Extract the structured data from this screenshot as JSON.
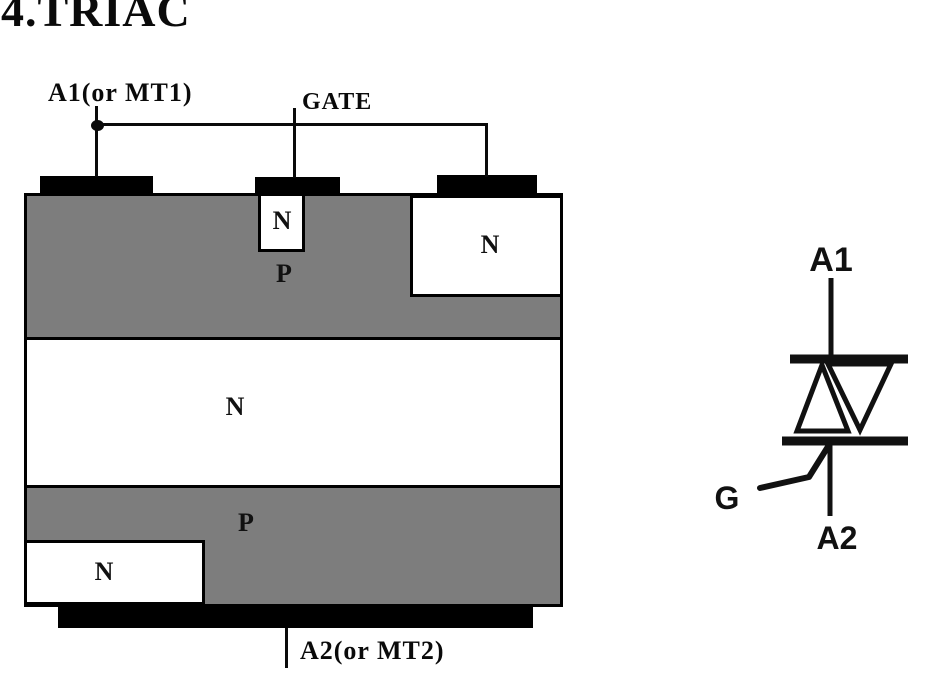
{
  "page": {
    "title": "4.TRIAC"
  },
  "structure": {
    "terminal_a1": "A1(or MT1)",
    "terminal_gate": "GATE",
    "terminal_a2": "A2(or MT2)",
    "labels": {
      "gate_n_well": "N",
      "top_p": "P",
      "right_n": "N",
      "middle_n": "N",
      "bottom_p": "P",
      "bottom_left_n": "N"
    }
  },
  "symbol": {
    "a1": "A1",
    "gate": "G",
    "a2": "A2"
  },
  "colors": {
    "p_region": "#7d7d7d",
    "n_region": "#ffffff",
    "electrode": "#000000",
    "line": "#0a0a0a",
    "background": "#ffffff"
  }
}
